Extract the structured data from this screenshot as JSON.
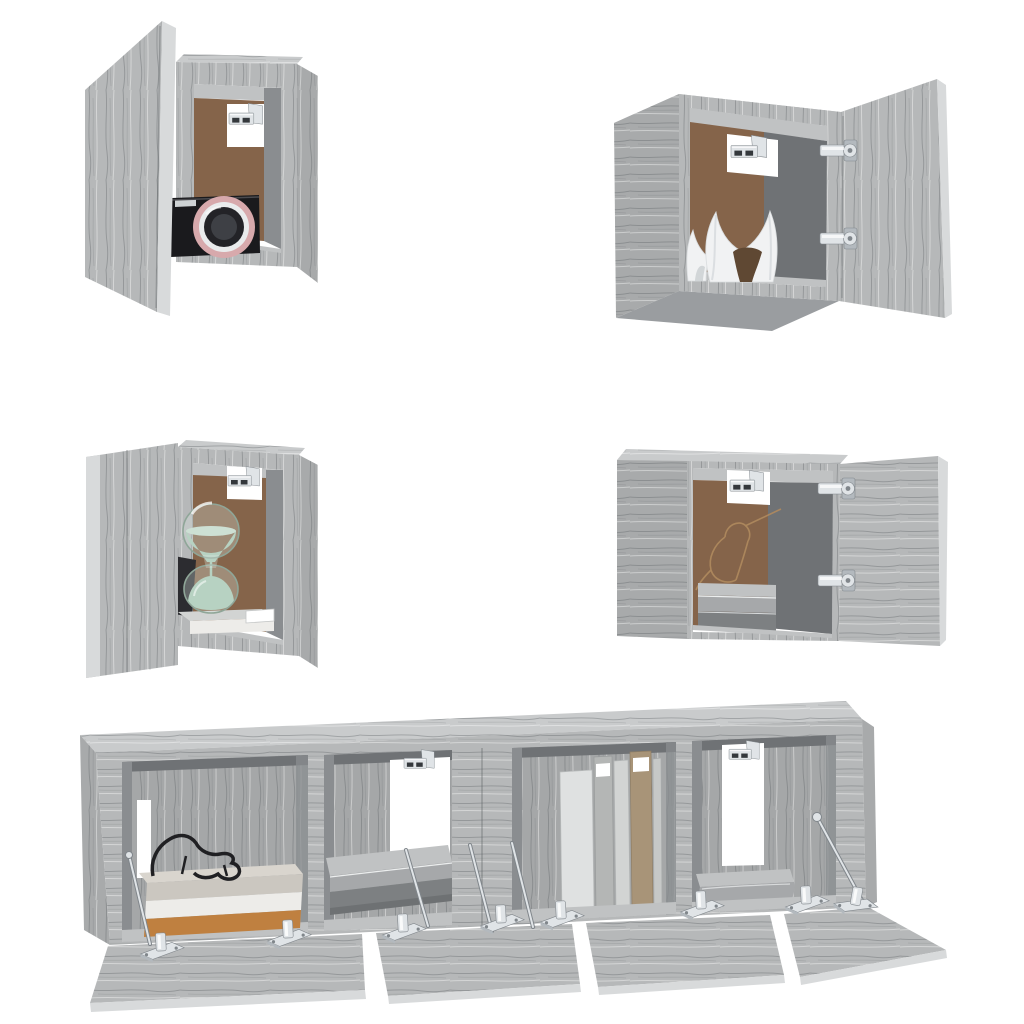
{
  "meta": {
    "title": "Product photo: 6-piece wall-mounted TV cabinet set, grey sonoma oak, open doors showing decor",
    "visible_text": "",
    "background": "#ffffff"
  },
  "palette": {
    "background": "#ffffff",
    "wood": "#b6b8b9",
    "woodLight": "#c9cbcc",
    "woodSide": "#a8aaab",
    "woodDark": "#989b9d",
    "woodEdge": "#d8dadb",
    "woodBottom": "#9a9da0",
    "grainLine": "#84888b",
    "interiorBack": "#a5a7a8",
    "interiorWall": "#8a8d90",
    "interiorShadow": "#6f7275",
    "floor": "#c0c2c3",
    "panelBrown": "#85644a",
    "panelBrownDark": "#5f4833",
    "chrome": "#e0e4e7",
    "chromeMid": "#b3b9be",
    "chromeDark": "#80868b",
    "slot": "#34383c",
    "white": "#ffffff",
    "cameraBody": "#1a1a1d",
    "cameraChip": "#ced2d4",
    "ringPink": "#d7a9ac",
    "ringSilver": "#e9ebec",
    "lensDark": "#232327",
    "lensInner": "#3e4045",
    "sand": "#a7c8b3",
    "sandLight": "#c6dbcd",
    "glass": "#8fa698",
    "glassFill": "rgba(223,236,228,0.30)",
    "sculpture": "#f1f2f3",
    "sculptureShade": "#d2d6d8",
    "bird": "#b08a5e",
    "boxLid": "#cbc7c0",
    "boxLidTop": "#d9d5ce",
    "boxWhite": "#edece9",
    "boxOrange": "#bf8040",
    "wire": "#202023",
    "blanketLight": "#c0c2c3",
    "blanketFront": "#a6a8aa",
    "blanketDark": "#7d8082",
    "blanketDarker": "#6e7173",
    "book1": "#dfe1e1",
    "book2": "#b4b6b5",
    "book3": "#d2d4d3",
    "book4": "#a89478",
    "book5": "#c6c8c7",
    "darkVase": "#2c2c30"
  },
  "scene": {
    "cabinets": [
      {
        "id": "top-left",
        "kind": "wall cube cabinet",
        "door": "open to left",
        "contents": [
          "compact camera"
        ]
      },
      {
        "id": "top-right",
        "kind": "wall cube cabinet",
        "door": "open to right",
        "contents": [
          "white sculptural vase"
        ]
      },
      {
        "id": "middle-left",
        "kind": "wall cube cabinet",
        "door": "open to left",
        "contents": [
          "hourglass with green sand",
          "book",
          "dark vase"
        ]
      },
      {
        "id": "middle-right",
        "kind": "wall cube cabinet",
        "door": "open to right",
        "contents": [
          "bird line-art on back panel",
          "folded grey blankets"
        ]
      },
      {
        "id": "bottom-left-unit",
        "kind": "hanging TV cabinet",
        "door": "two flap doors open downward",
        "contents": [
          "storage boxes",
          "black wire animal figurine",
          "folded grey blankets"
        ]
      },
      {
        "id": "bottom-right-unit",
        "kind": "hanging TV cabinet",
        "door": "two flap doors open downward",
        "contents": [
          "row of books",
          "rolled grey blanket"
        ]
      }
    ],
    "hardware": [
      "wall-mount brackets",
      "chrome cup hinges",
      "lid stay rods"
    ],
    "material": "grey sonoma oak engineered wood",
    "interior_panel": "brown hardboard back"
  }
}
